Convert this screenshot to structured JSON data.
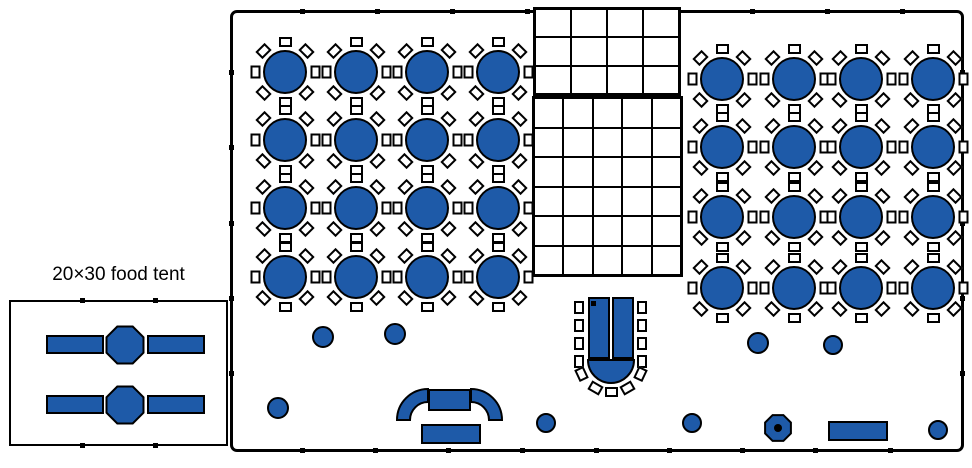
{
  "colors": {
    "table_blue": "#1e5aa8",
    "line": "#000000",
    "background": "#ffffff"
  },
  "food_tent": {
    "label": "20×30 food tent",
    "label_pos": {
      "x": 9,
      "y": 264,
      "w": 219
    },
    "box": {
      "x": 9,
      "y": 300,
      "w": 219,
      "h": 146
    },
    "tick_xs": [
      82,
      155
    ],
    "buffet_lines": [
      {
        "cy": 345
      },
      {
        "cy": 405
      }
    ],
    "buffet_geometry": {
      "rect_w": 58,
      "rect_h": 19,
      "left_rect_x": 46,
      "right_rect_x": 147,
      "octagon_cx": 125,
      "octagon_r": 20
    }
  },
  "main_tent": {
    "box": {
      "x": 230,
      "y": 10,
      "w": 734,
      "h": 442
    },
    "ticks_top_x": [
      302,
      377,
      452,
      527,
      752,
      827,
      902
    ],
    "ticks_bottom_x": [
      302,
      375,
      448,
      522,
      596,
      669,
      742,
      815,
      890
    ],
    "ticks_side_y": [
      72,
      147,
      223,
      298,
      373
    ],
    "pole_dots": [
      {
        "x": 595,
        "y": 155
      },
      {
        "x": 377,
        "y": 302
      }
    ]
  },
  "dance_floor": {
    "upper_grid": {
      "x": 533,
      "y": 7,
      "w": 148,
      "h": 89,
      "cols": 4,
      "rows": 3
    },
    "lower_grid": {
      "x": 532,
      "y": 96,
      "w": 151,
      "h": 181,
      "cols": 5,
      "rows": 6
    }
  },
  "guest_tables": {
    "seats_per_table": 8,
    "table_diameter": 44,
    "chair_offset": 30,
    "chair_angles": [
      90,
      45,
      0,
      -45,
      -90,
      -135,
      180,
      135
    ],
    "left_group": {
      "cols_x": [
        285,
        356,
        427,
        498
      ],
      "rows_y": [
        72,
        140,
        208,
        277
      ]
    },
    "right_group": {
      "cols_x": [
        722,
        794,
        861,
        933
      ],
      "rows_y": [
        79,
        147,
        217,
        288
      ]
    }
  },
  "head_table": {
    "sections": [
      {
        "x": 588,
        "y": 297,
        "w": 22,
        "h": 62
      },
      {
        "x": 612,
        "y": 297,
        "w": 22,
        "h": 62
      }
    ],
    "corner_marker": {
      "x": 591,
      "y": 301,
      "size": 5
    },
    "semicircle": {
      "cx": 611,
      "cy": 360,
      "r": 23
    },
    "side_chair_ys": [
      301,
      319,
      337,
      355
    ],
    "left_chair_x": 574,
    "right_chair_x": 637,
    "fan_chair_angles": [
      205,
      240,
      270,
      300,
      335
    ],
    "fan_chair_radius": 32
  },
  "serving_area": {
    "arc_center_rect": {
      "x": 428,
      "y": 389,
      "w": 43,
      "h": 22
    },
    "arc_wing_outer_r": 31,
    "arc_wing_inner_r": 18,
    "arc_left_end_x": 397,
    "arc_right_end_x": 502,
    "arc_base_y": 420,
    "lower_rect": {
      "x": 421,
      "y": 424,
      "w": 60,
      "h": 20
    }
  },
  "cake_table": {
    "cx": 778,
    "cy": 428,
    "r": 14,
    "dot_r": 4
  },
  "rect_table_bottom_right": {
    "x": 828,
    "y": 421,
    "w": 60,
    "h": 20
  },
  "misc_round_tables": [
    {
      "cx": 323,
      "cy": 337,
      "r": 11
    },
    {
      "cx": 395,
      "cy": 334,
      "r": 11
    },
    {
      "cx": 278,
      "cy": 408,
      "r": 11
    },
    {
      "cx": 546,
      "cy": 423,
      "r": 10
    },
    {
      "cx": 692,
      "cy": 423,
      "r": 10
    },
    {
      "cx": 758,
      "cy": 343,
      "r": 11
    },
    {
      "cx": 833,
      "cy": 345,
      "r": 10
    },
    {
      "cx": 938,
      "cy": 430,
      "r": 10
    }
  ]
}
